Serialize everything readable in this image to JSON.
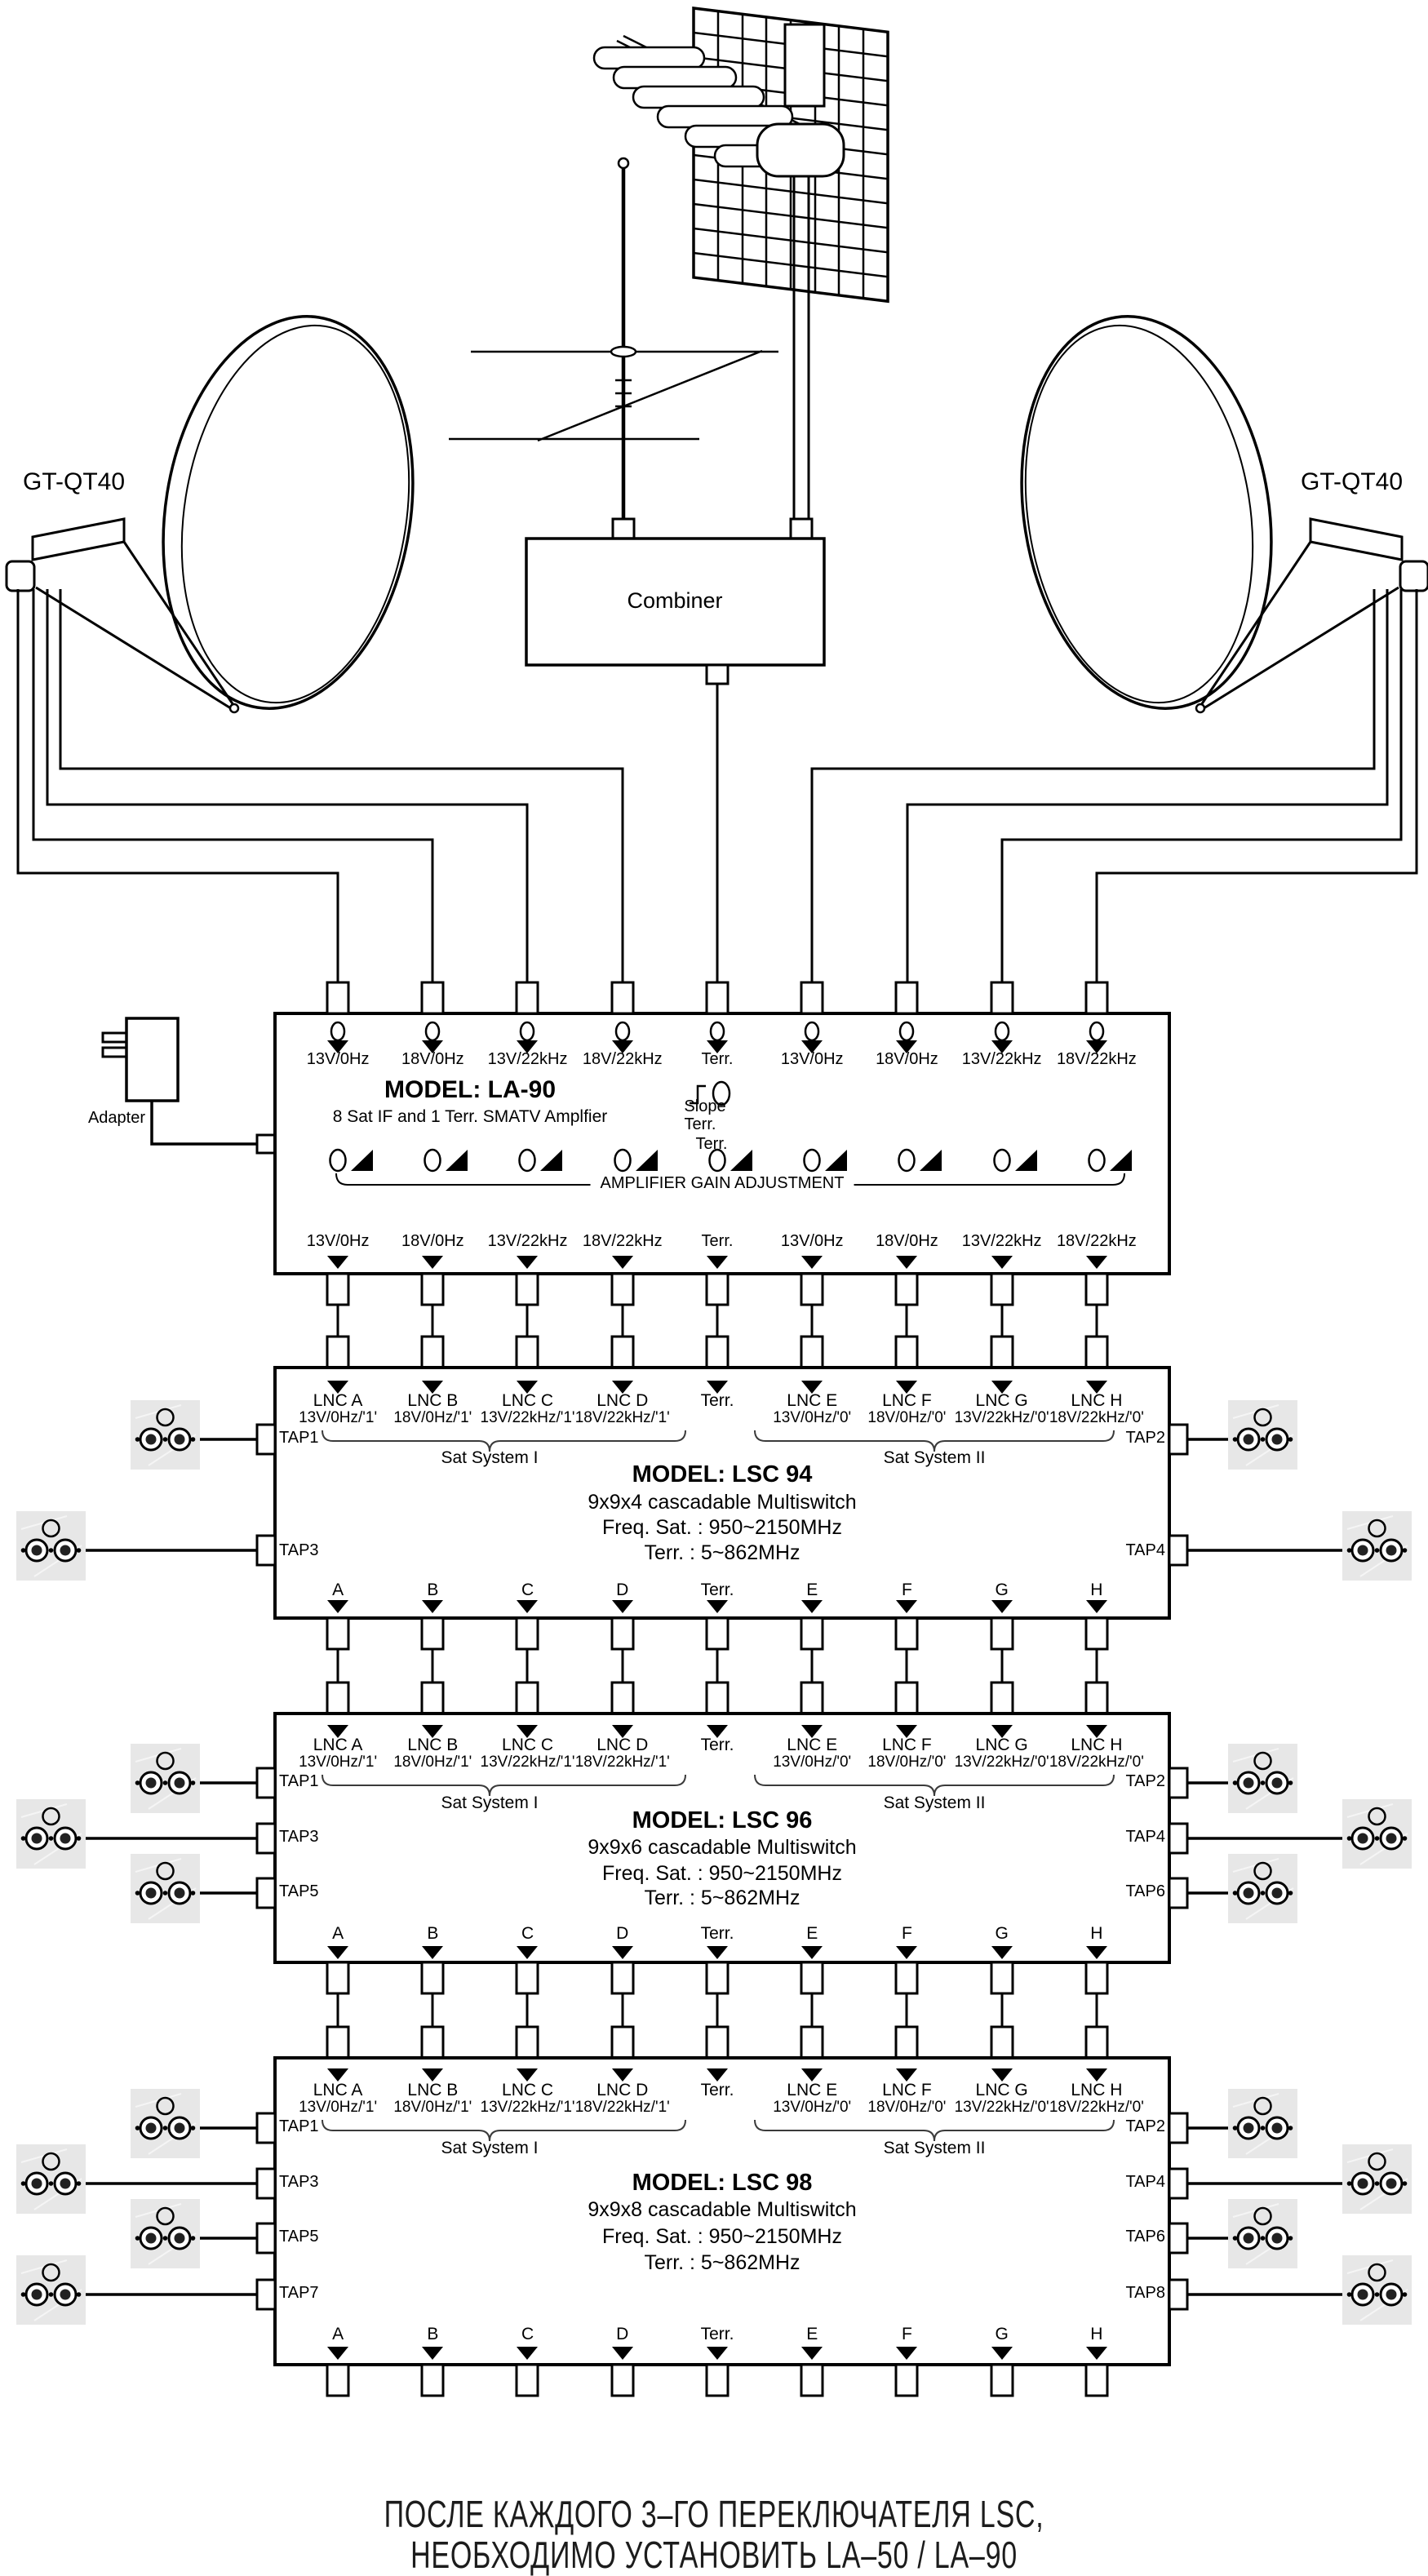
{
  "antennas": {
    "dish_left_label": "GT-QT40",
    "dish_right_label": "GT-QT40",
    "combiner_label": "Combiner"
  },
  "adapter": {
    "label": "Adapter"
  },
  "la90": {
    "model": "MODEL: LA-90",
    "subtitle": "8 Sat IF and 1 Terr. SMATV Amplfier",
    "slope_label": "Slope",
    "slope_terr_label": "Terr.",
    "gain_terr_label": "Terr.",
    "gain_caption": "AMPLIFIER GAIN ADJUSTMENT",
    "inputs": [
      "13V/0Hz",
      "18V/0Hz",
      "13V/22kHz",
      "18V/22kHz",
      "Terr.",
      "13V/0Hz",
      "18V/0Hz",
      "13V/22kHz",
      "18V/22kHz"
    ],
    "outputs": [
      "13V/0Hz",
      "18V/0Hz",
      "13V/22kHz",
      "18V/22kHz",
      "Terr.",
      "13V/0Hz",
      "18V/0Hz",
      "13V/22kHz",
      "18V/22kHz"
    ]
  },
  "switches": [
    {
      "model": "MODEL: LSC 94",
      "type": "9x9x4 cascadable Multiswitch",
      "sat_range": "Freq.  Sat. : 950~2150MHz",
      "terr_range": "Terr. : 5~862MHz",
      "group1": "Sat System I",
      "group2": "Sat System II",
      "input_names": [
        "LNC A",
        "LNC B",
        "LNC C",
        "LNC D",
        "Terr.",
        "LNC E",
        "LNC F",
        "LNC G",
        "LNC H"
      ],
      "input_modes": [
        "13V/0Hz/'1'",
        "18V/0Hz/'1'",
        "13V/22kHz/'1'",
        "18V/22kHz/'1'",
        "",
        "13V/0Hz/'0'",
        "18V/0Hz/'0'",
        "13V/22kHz/'0'",
        "18V/22kHz/'0'"
      ],
      "outputs": [
        "A",
        "B",
        "C",
        "D",
        "Terr.",
        "E",
        "F",
        "G",
        "H"
      ],
      "taps_left": [
        "TAP1",
        "TAP3"
      ],
      "taps_right": [
        "TAP2",
        "TAP4"
      ]
    },
    {
      "model": "MODEL: LSC 96",
      "type": "9x9x6 cascadable Multiswitch",
      "sat_range": "Freq.  Sat. : 950~2150MHz",
      "terr_range": "Terr. : 5~862MHz",
      "group1": "Sat System I",
      "group2": "Sat System II",
      "input_names": [
        "LNC A",
        "LNC B",
        "LNC C",
        "LNC D",
        "Terr.",
        "LNC E",
        "LNC F",
        "LNC G",
        "LNC H"
      ],
      "input_modes": [
        "13V/0Hz/'1'",
        "18V/0Hz/'1'",
        "13V/22kHz/'1'",
        "18V/22kHz/'1'",
        "",
        "13V/0Hz/'0'",
        "18V/0Hz/'0'",
        "13V/22kHz/'0'",
        "18V/22kHz/'0'"
      ],
      "outputs": [
        "A",
        "B",
        "C",
        "D",
        "Terr.",
        "E",
        "F",
        "G",
        "H"
      ],
      "taps_left": [
        "TAP1",
        "TAP3",
        "TAP5"
      ],
      "taps_right": [
        "TAP2",
        "TAP4",
        "TAP6"
      ]
    },
    {
      "model": "MODEL: LSC 98",
      "type": "9x9x8 cascadable Multiswitch",
      "sat_range": "Freq.  Sat. : 950~2150MHz",
      "terr_range": "Terr. : 5~862MHz",
      "group1": "Sat System I",
      "group2": "Sat System II",
      "input_names": [
        "LNC A",
        "LNC B",
        "LNC C",
        "LNC D",
        "Terr.",
        "LNC E",
        "LNC F",
        "LNC G",
        "LNC H"
      ],
      "input_modes": [
        "13V/0Hz/'1'",
        "18V/0Hz/'1'",
        "13V/22kHz/'1'",
        "18V/22kHz/'1'",
        "",
        "13V/0Hz/'0'",
        "18V/0Hz/'0'",
        "13V/22kHz/'0'",
        "18V/22kHz/'0'"
      ],
      "outputs": [
        "A",
        "B",
        "C",
        "D",
        "Terr.",
        "E",
        "F",
        "G",
        "H"
      ],
      "taps_left": [
        "TAP1",
        "TAP3",
        "TAP5",
        "TAP7"
      ],
      "taps_right": [
        "TAP2",
        "TAP4",
        "TAP6",
        "TAP8"
      ]
    }
  ],
  "note": {
    "line1": "ПОСЛЕ КАЖДОГО 3–ГО ПЕРЕКЛЮЧАТЕЛЯ LSC,",
    "line2": "НЕОБХОДИМО УСТАНОВИТЬ LA–50 / LA–90"
  }
}
